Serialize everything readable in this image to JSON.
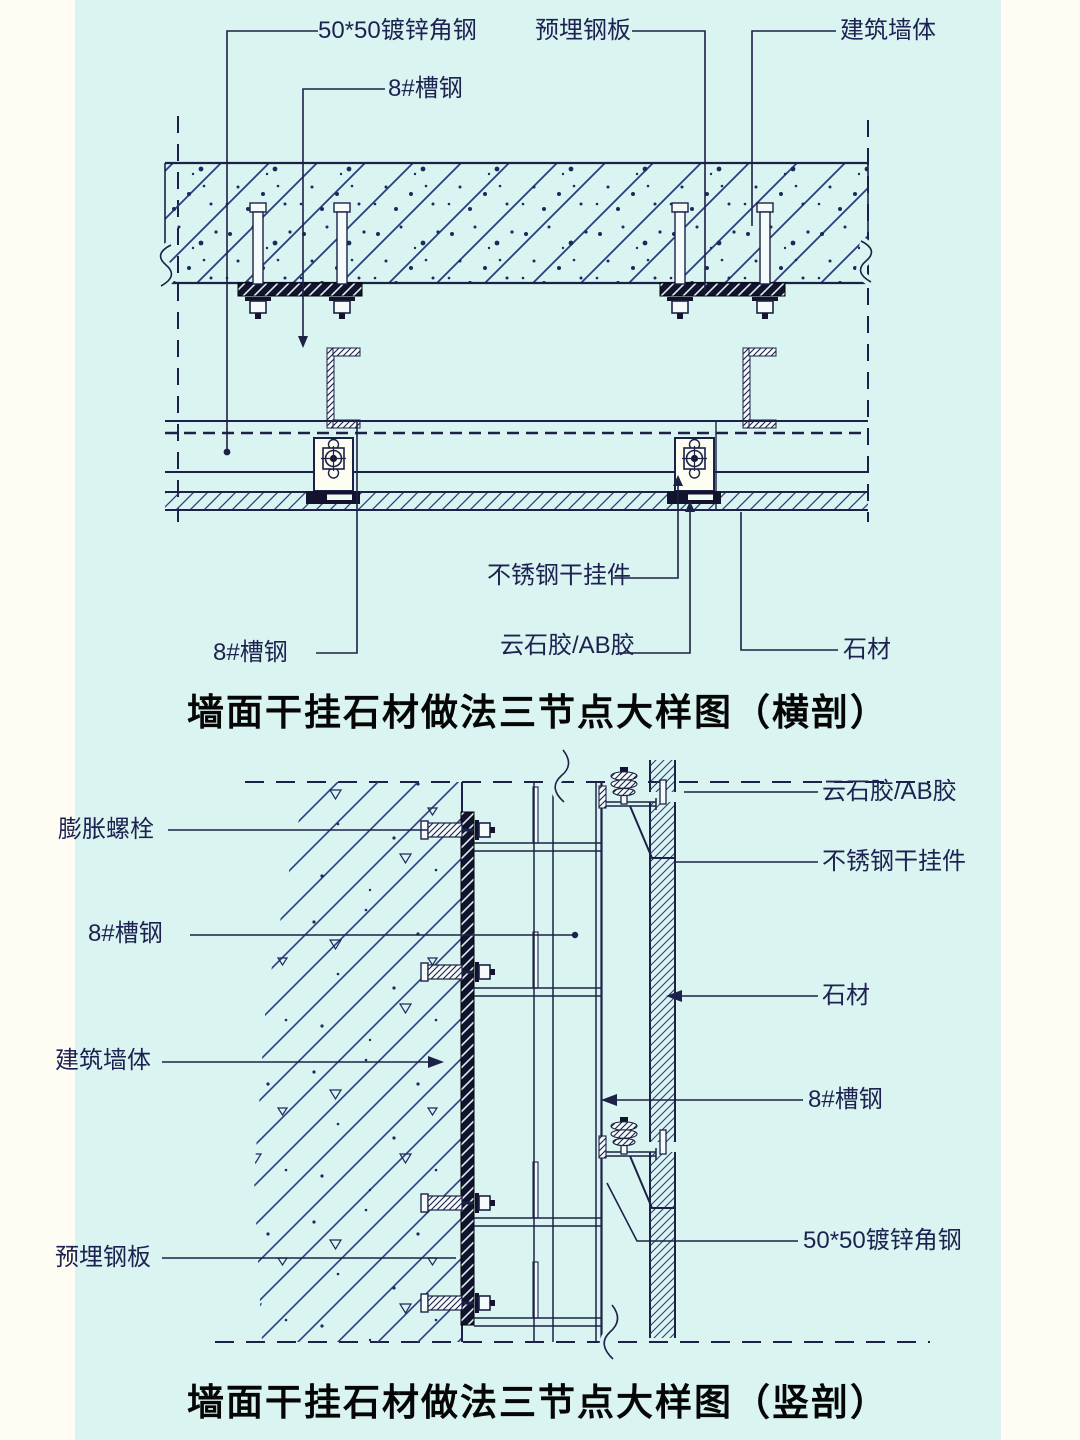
{
  "colors": {
    "background": "#d9f4f1",
    "margin_background": "#fffdf3",
    "line": "#1c2147",
    "hatch_blue": "#2c3d7c",
    "dark_fill": "#13132e",
    "title_black": "#060606"
  },
  "top_diagram": {
    "title": "墙面干挂石材做法三节点大样图（横剖）",
    "labels": {
      "angle_steel": "50*50镀锌角钢",
      "channel_top": "8#槽钢",
      "embed_plate": "预埋钢板",
      "wall": "建筑墙体",
      "channel_bottom": "8#槽钢",
      "hanger": "不锈钢干挂件",
      "glue": "云石胶/AB胶",
      "stone": "石材"
    }
  },
  "bottom_diagram": {
    "title": "墙面干挂石材做法三节点大样图（竖剖）",
    "labels": {
      "glue": "云石胶/AB胶",
      "hanger": "不锈钢干挂件",
      "stone": "石材",
      "channel_right": "8#槽钢",
      "angle_steel": "50*50镀锌角钢",
      "anchor_bolt": "膨胀螺栓",
      "channel_left": "8#槽钢",
      "wall": "建筑墙体",
      "embed_plate": "预埋钢板"
    }
  }
}
